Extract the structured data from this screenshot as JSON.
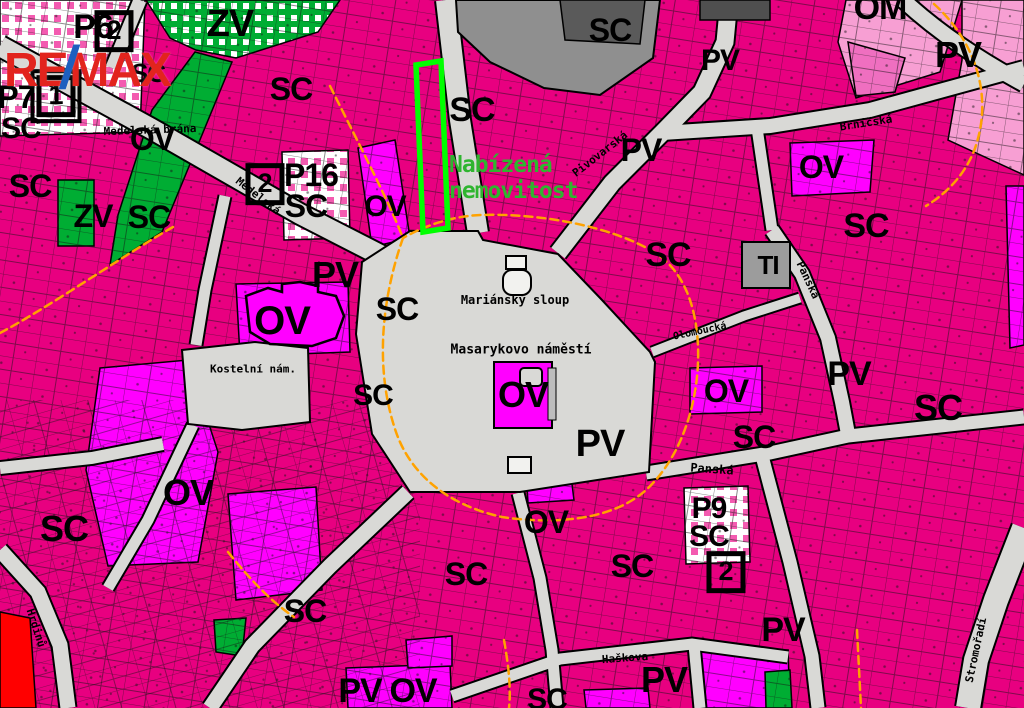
{
  "branding": {
    "re": "RE",
    "slash": "/",
    "max": "MAX"
  },
  "highlight": {
    "label_line1": "Nabízená",
    "label_line2": "nemovitost",
    "outline_color": "#00ff00",
    "text_color": "#2fb52f"
  },
  "legend_colors": {
    "sc_zone_pink": "#e80080",
    "ov_zone_magenta": "#ff00ff",
    "zv_zone_green": "#00ad33",
    "om_zone_lightpink": "#f79fd3",
    "street_gray": "#d9d9d6",
    "building_gray": "#8f8f8f",
    "boundary_orange": "#ffa200",
    "red_area": "#ff0000"
  },
  "zone_labels": [
    {
      "name": "zone-label-p6",
      "text": "P6",
      "x": 93,
      "y": 27,
      "size": 34
    },
    {
      "name": "zone-label-sc",
      "text": "SC",
      "x": 148,
      "y": 73,
      "size": 26
    },
    {
      "name": "zone-label-zv",
      "text": "ZV",
      "x": 230,
      "y": 24,
      "size": 38
    },
    {
      "name": "zone-label-sc",
      "text": "SC",
      "x": 291,
      "y": 89,
      "size": 32
    },
    {
      "name": "zone-label-p7",
      "text": "P7",
      "x": 16,
      "y": 97,
      "size": 32
    },
    {
      "name": "zone-label-sc",
      "text": "SC",
      "x": 21,
      "y": 129,
      "size": 30
    },
    {
      "name": "zone-label-sc",
      "text": "SC",
      "x": 472,
      "y": 110,
      "size": 34
    },
    {
      "name": "zone-label-sc",
      "text": "SC",
      "x": 610,
      "y": 30,
      "size": 32
    },
    {
      "name": "zone-label-pv",
      "text": "PV",
      "x": 720,
      "y": 61,
      "size": 30
    },
    {
      "name": "zone-label-om",
      "text": "OM",
      "x": 880,
      "y": 8,
      "size": 34
    },
    {
      "name": "zone-label-pv",
      "text": "PV",
      "x": 958,
      "y": 55,
      "size": 36
    },
    {
      "name": "zone-label-ov",
      "text": "OV",
      "x": 821,
      "y": 167,
      "size": 32
    },
    {
      "name": "zone-label-sc",
      "text": "SC",
      "x": 866,
      "y": 226,
      "size": 34
    },
    {
      "name": "zone-label-pv",
      "text": "PV",
      "x": 641,
      "y": 150,
      "size": 32
    },
    {
      "name": "zone-label-ov",
      "text": "OV",
      "x": 152,
      "y": 139,
      "size": 32
    },
    {
      "name": "zone-label-sc",
      "text": "SC",
      "x": 30,
      "y": 186,
      "size": 32
    },
    {
      "name": "zone-label-zv",
      "text": "ZV",
      "x": 93,
      "y": 216,
      "size": 32
    },
    {
      "name": "zone-label-sc",
      "text": "SC",
      "x": 149,
      "y": 217,
      "size": 32
    },
    {
      "name": "zone-label-p16",
      "text": "P16",
      "x": 311,
      "y": 175,
      "size": 32
    },
    {
      "name": "zone-label-sc",
      "text": "SC",
      "x": 306,
      "y": 206,
      "size": 32
    },
    {
      "name": "zone-label-ov",
      "text": "OV",
      "x": 385,
      "y": 207,
      "size": 30
    },
    {
      "name": "zone-label-sc",
      "text": "SC",
      "x": 668,
      "y": 255,
      "size": 34
    },
    {
      "name": "zone-label-ti",
      "text": "TI",
      "x": 768,
      "y": 265,
      "size": 26
    },
    {
      "name": "zone-label-pv",
      "text": "PV",
      "x": 335,
      "y": 275,
      "size": 36
    },
    {
      "name": "zone-label-ov",
      "text": "OV",
      "x": 282,
      "y": 321,
      "size": 40
    },
    {
      "name": "zone-label-sc",
      "text": "SC",
      "x": 397,
      "y": 309,
      "size": 32
    },
    {
      "name": "zone-label-sc",
      "text": "SC",
      "x": 373,
      "y": 396,
      "size": 30
    },
    {
      "name": "zone-label-ov",
      "text": "OV",
      "x": 523,
      "y": 395,
      "size": 36
    },
    {
      "name": "zone-label-pv",
      "text": "PV",
      "x": 600,
      "y": 444,
      "size": 38
    },
    {
      "name": "zone-label-pv",
      "text": "PV",
      "x": 849,
      "y": 374,
      "size": 34
    },
    {
      "name": "zone-label-ov",
      "text": "OV",
      "x": 726,
      "y": 391,
      "size": 32
    },
    {
      "name": "zone-label-sc",
      "text": "SC",
      "x": 754,
      "y": 437,
      "size": 32
    },
    {
      "name": "zone-label-sc",
      "text": "SC",
      "x": 938,
      "y": 408,
      "size": 36
    },
    {
      "name": "zone-label-ov",
      "text": "OV",
      "x": 188,
      "y": 493,
      "size": 36
    },
    {
      "name": "zone-label-sc",
      "text": "SC",
      "x": 64,
      "y": 529,
      "size": 36
    },
    {
      "name": "zone-label-ov",
      "text": "OV",
      "x": 546,
      "y": 522,
      "size": 32
    },
    {
      "name": "zone-label-sc",
      "text": "SC",
      "x": 466,
      "y": 574,
      "size": 32
    },
    {
      "name": "zone-label-sc",
      "text": "SC",
      "x": 632,
      "y": 566,
      "size": 32
    },
    {
      "name": "zone-label-p9",
      "text": "P9",
      "x": 709,
      "y": 509,
      "size": 30
    },
    {
      "name": "zone-label-sc",
      "text": "SC",
      "x": 709,
      "y": 537,
      "size": 30
    },
    {
      "name": "zone-label-sc",
      "text": "SC",
      "x": 305,
      "y": 611,
      "size": 32
    },
    {
      "name": "zone-label-pv",
      "text": "PV",
      "x": 783,
      "y": 630,
      "size": 34
    },
    {
      "name": "zone-label-pv",
      "text": "PV",
      "x": 360,
      "y": 691,
      "size": 34
    },
    {
      "name": "zone-label-ov",
      "text": "OV",
      "x": 413,
      "y": 691,
      "size": 34
    },
    {
      "name": "zone-label-sc",
      "text": "SC",
      "x": 547,
      "y": 700,
      "size": 30
    },
    {
      "name": "zone-label-pv",
      "text": "PV",
      "x": 664,
      "y": 680,
      "size": 36
    }
  ],
  "street_labels": [
    {
      "name": "street-label-medelska-brana",
      "text": "Medelská brána",
      "x": 150,
      "y": 130,
      "size": 11,
      "rot": -2
    },
    {
      "name": "street-label-medelska",
      "text": "Medelská",
      "x": 258,
      "y": 196,
      "size": 11,
      "rot": 38
    },
    {
      "name": "street-label-pivovarska",
      "text": "Pivovarská",
      "x": 600,
      "y": 154,
      "size": 11,
      "rot": -38
    },
    {
      "name": "street-label-brnicska",
      "text": "Brníčská",
      "x": 866,
      "y": 123,
      "size": 11,
      "rot": -9
    },
    {
      "name": "street-label-panska-vertical",
      "text": "Panská",
      "x": 808,
      "y": 280,
      "size": 11,
      "rot": 65
    },
    {
      "name": "street-label-panska",
      "text": "Panská",
      "x": 712,
      "y": 469,
      "size": 12,
      "rot": 4
    },
    {
      "name": "street-label-olomoucka",
      "text": "Olomoucká",
      "x": 700,
      "y": 332,
      "size": 10,
      "rot": -12
    },
    {
      "name": "street-label-hrdinu",
      "text": "Hrdinů",
      "x": 36,
      "y": 628,
      "size": 11,
      "rot": 72
    },
    {
      "name": "street-label-haskova",
      "text": "Haškova",
      "x": 625,
      "y": 658,
      "size": 11,
      "rot": -4
    },
    {
      "name": "street-label-stromoradi",
      "text": "Stromořadí",
      "x": 976,
      "y": 650,
      "size": 11,
      "rot": -78
    }
  ],
  "place_labels": [
    {
      "name": "place-label-kostelni-namesti",
      "text": "Kostelní nám.",
      "x": 253,
      "y": 369,
      "size": 11
    },
    {
      "name": "place-label-mariansky-sloup",
      "text": "Mariánský sloup",
      "x": 515,
      "y": 300,
      "size": 12
    },
    {
      "name": "place-label-masarykovo-namesti",
      "text": "Masarykovo náměstí",
      "x": 521,
      "y": 350,
      "size": 13
    }
  ],
  "markers": [
    {
      "name": "planning-marker-p6",
      "text": "2",
      "x": 114,
      "y": 31,
      "double": false
    },
    {
      "name": "planning-marker-p7",
      "text": "1",
      "x": 56,
      "y": 96,
      "double": true
    },
    {
      "name": "planning-marker-p16",
      "text": "2",
      "x": 265,
      "y": 184,
      "double": false
    },
    {
      "name": "planning-marker-p9",
      "text": "2",
      "x": 726,
      "y": 572,
      "double": false
    }
  ]
}
